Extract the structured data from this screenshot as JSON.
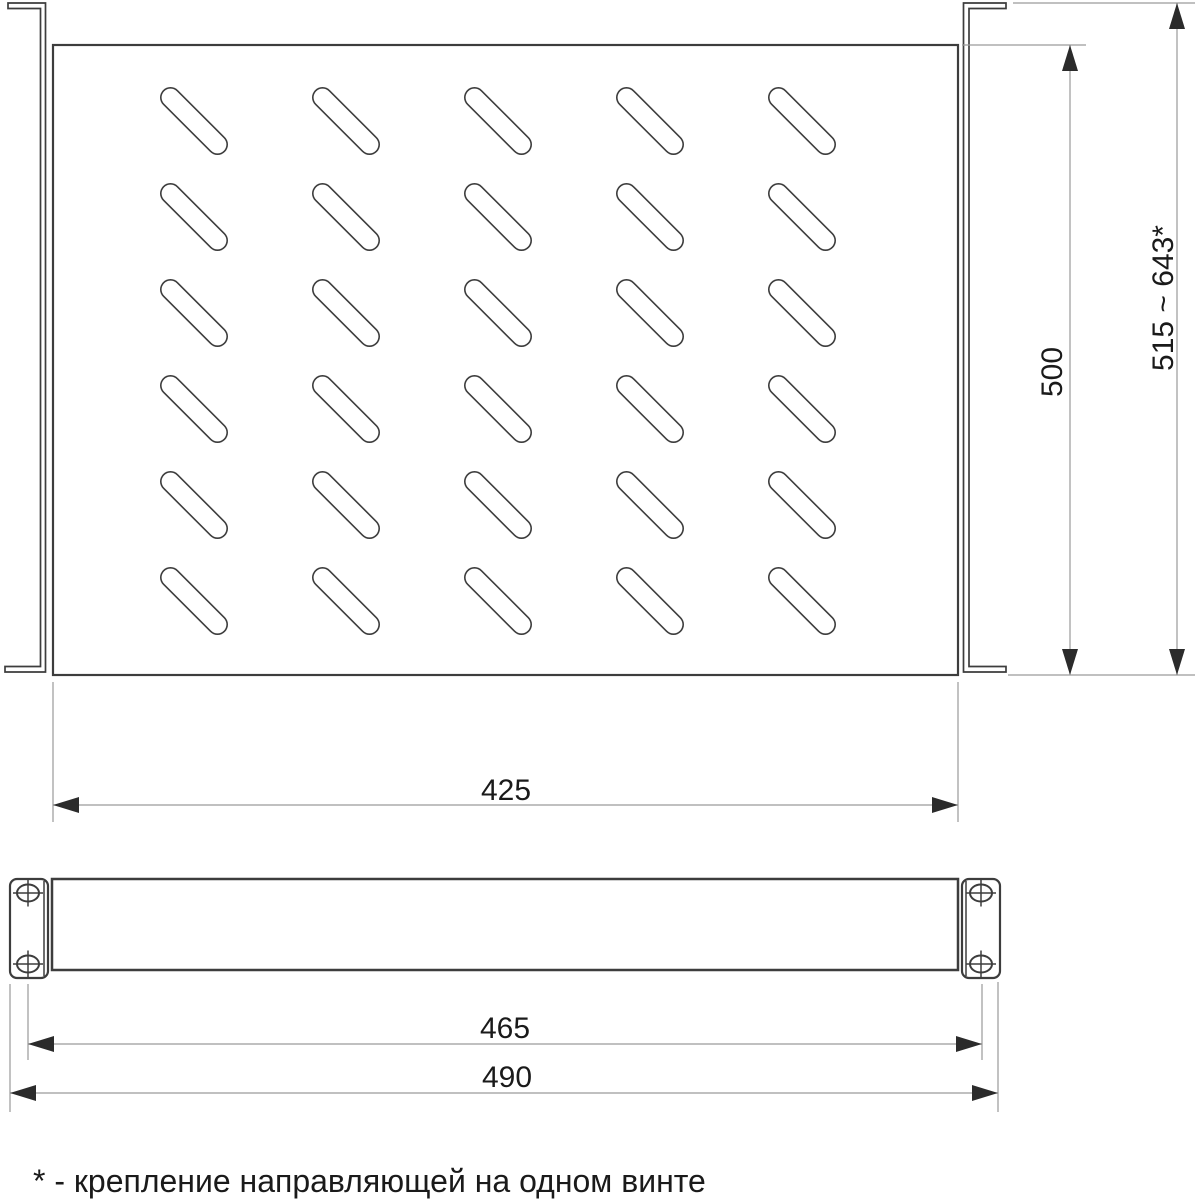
{
  "drawing": {
    "title": "rack-shelf-dimension-drawing",
    "top_view": {
      "dim_plate_width": "425",
      "dim_plate_depth": "500",
      "dim_overall_depth": "515 ~ 643*",
      "slot_grid": {
        "columns": 5,
        "rows": 6,
        "col_start_x": 160,
        "row_start_y": 87,
        "col_pitch": 152,
        "row_pitch": 96,
        "slot_box": 68,
        "slot_radius": 10.5
      }
    },
    "front_view": {
      "dim_hole_spacing": "465",
      "dim_overall_width": "490",
      "screw_holes": [
        {
          "cx": 28,
          "cy": 893
        },
        {
          "cx": 28,
          "cy": 964
        },
        {
          "cx": 981,
          "cy": 893
        },
        {
          "cx": 981,
          "cy": 964
        }
      ],
      "hole_rx": 11,
      "hole_ry": 8.5,
      "crosshair_half_w": 15,
      "crosshair_half_h": 13.5
    },
    "footnote": "* - крепление направляющей на одном винте"
  },
  "colors": {
    "line": "#3d3d3d",
    "dim_line": "#9a9a9a",
    "arrow": "#2b2b2b",
    "text": "#1a1a1a",
    "background": "#ffffff"
  }
}
